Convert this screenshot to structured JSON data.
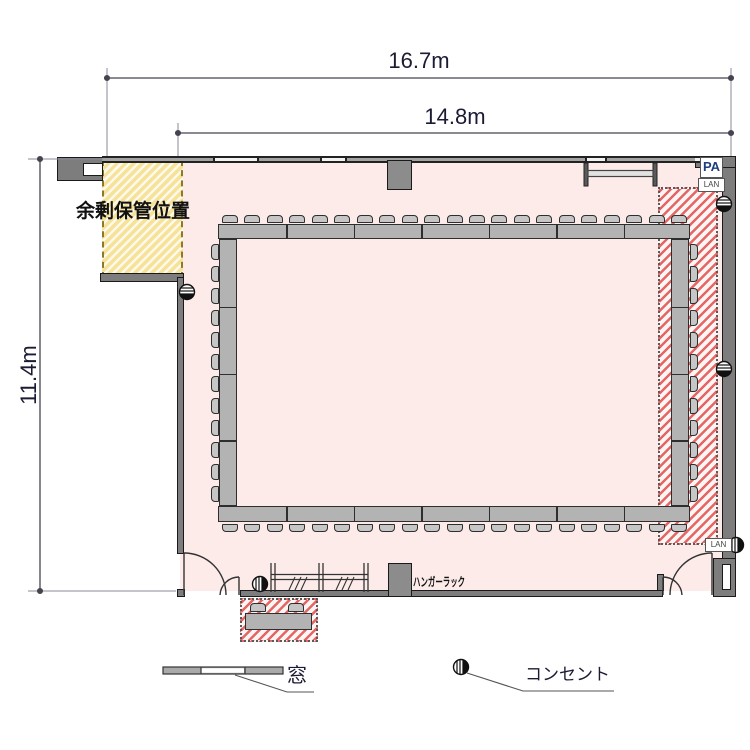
{
  "dimensions": {
    "outer_width": "16.7m",
    "inner_width": "14.8m",
    "height": "11.4m"
  },
  "labels": {
    "storage_area": "余剰保管位置",
    "hanger_rack": "ハンガーラック",
    "pa": "PA",
    "lan_top": "LAN",
    "lan_bottom": "LAN"
  },
  "legend": {
    "window": "窓",
    "outlet": "コンセント"
  },
  "floorplan": {
    "layout_type": "closed-square meeting layout with perimeter chairs",
    "tables": {
      "top_segments": 7,
      "bottom_segments": 7,
      "left_segments": 4,
      "right_segments": 4,
      "reception_desks": 1
    },
    "chairs": {
      "top": 21,
      "bottom": 21,
      "left": 12,
      "right": 12,
      "reception": 2
    },
    "outlets": {
      "count": 6
    },
    "doors": {
      "count": 2
    },
    "colors": {
      "room_fill": "#fcebe9",
      "storage_fill": "#f7e29a",
      "red_hatch": "#e04c4c",
      "wall": "#7d7d7d",
      "table": "#b3b3b3",
      "text": "#1b1b33",
      "pa_text": "#1f3f7a"
    }
  }
}
